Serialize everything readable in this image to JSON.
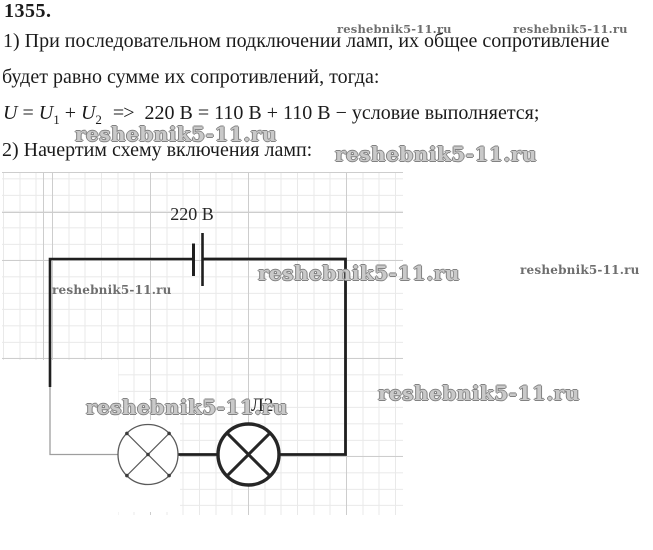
{
  "title": {
    "problem_number": "1355."
  },
  "solution": {
    "line1": "1) При последовательном подключении ламп, их общее сопротивление",
    "line2": "будет равно сумме их сопротивлений, тогда:",
    "step2": "2) Начертим схему включения ламп:"
  },
  "formula": {
    "u_symbol": "U",
    "equals": "=",
    "plus": "+",
    "sub_1": "1",
    "sub_2": "2",
    "implies": "=>",
    "evaluation": "220 В = 110 В + 110 В − условие выполняется;"
  },
  "diagram": {
    "source_voltage": "220 В",
    "lamp2_label": "Л2",
    "wire_color": "#1f1f1f",
    "faint_wire_color": "#9e9e9e",
    "lamp1_color": "#5a5a5a",
    "lamp1_dot_color": "#3c3c3c",
    "lamp2_color": "#262626",
    "grid_minor_color": "#e9e9e9",
    "grid_major_color": "#cdcdcd"
  },
  "watermark": {
    "text": "reshebnik5-11.ru"
  }
}
